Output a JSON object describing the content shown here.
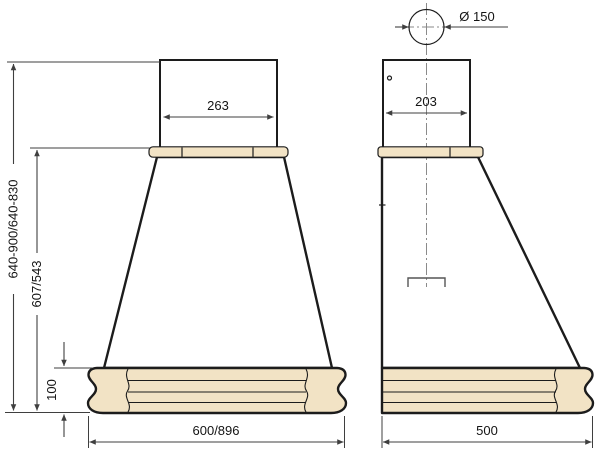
{
  "drawing": {
    "kind": "technical dimension drawing",
    "subject": "kitchen cooker hood, front and side views"
  },
  "dimensions": {
    "duct_diameter": "Ø 150",
    "chimney_width": "263",
    "chimney_depth": "203",
    "total_height": "640-900/640-830",
    "body_height": "607/543",
    "base_height": "100",
    "front_width": "600/896",
    "side_depth": "500"
  },
  "colors": {
    "outline": "#1c1c1c",
    "dim": "#3f3f3f",
    "wood": "#f2e3c5",
    "metal_light": "#f5f5f5",
    "metal_dark": "#bdbdc0",
    "body_top": "#ececec",
    "body_mid": "#ffffff",
    "body_bottom": "#e9e9e9",
    "centerline": "#8a8a8a",
    "text": "#141414"
  }
}
